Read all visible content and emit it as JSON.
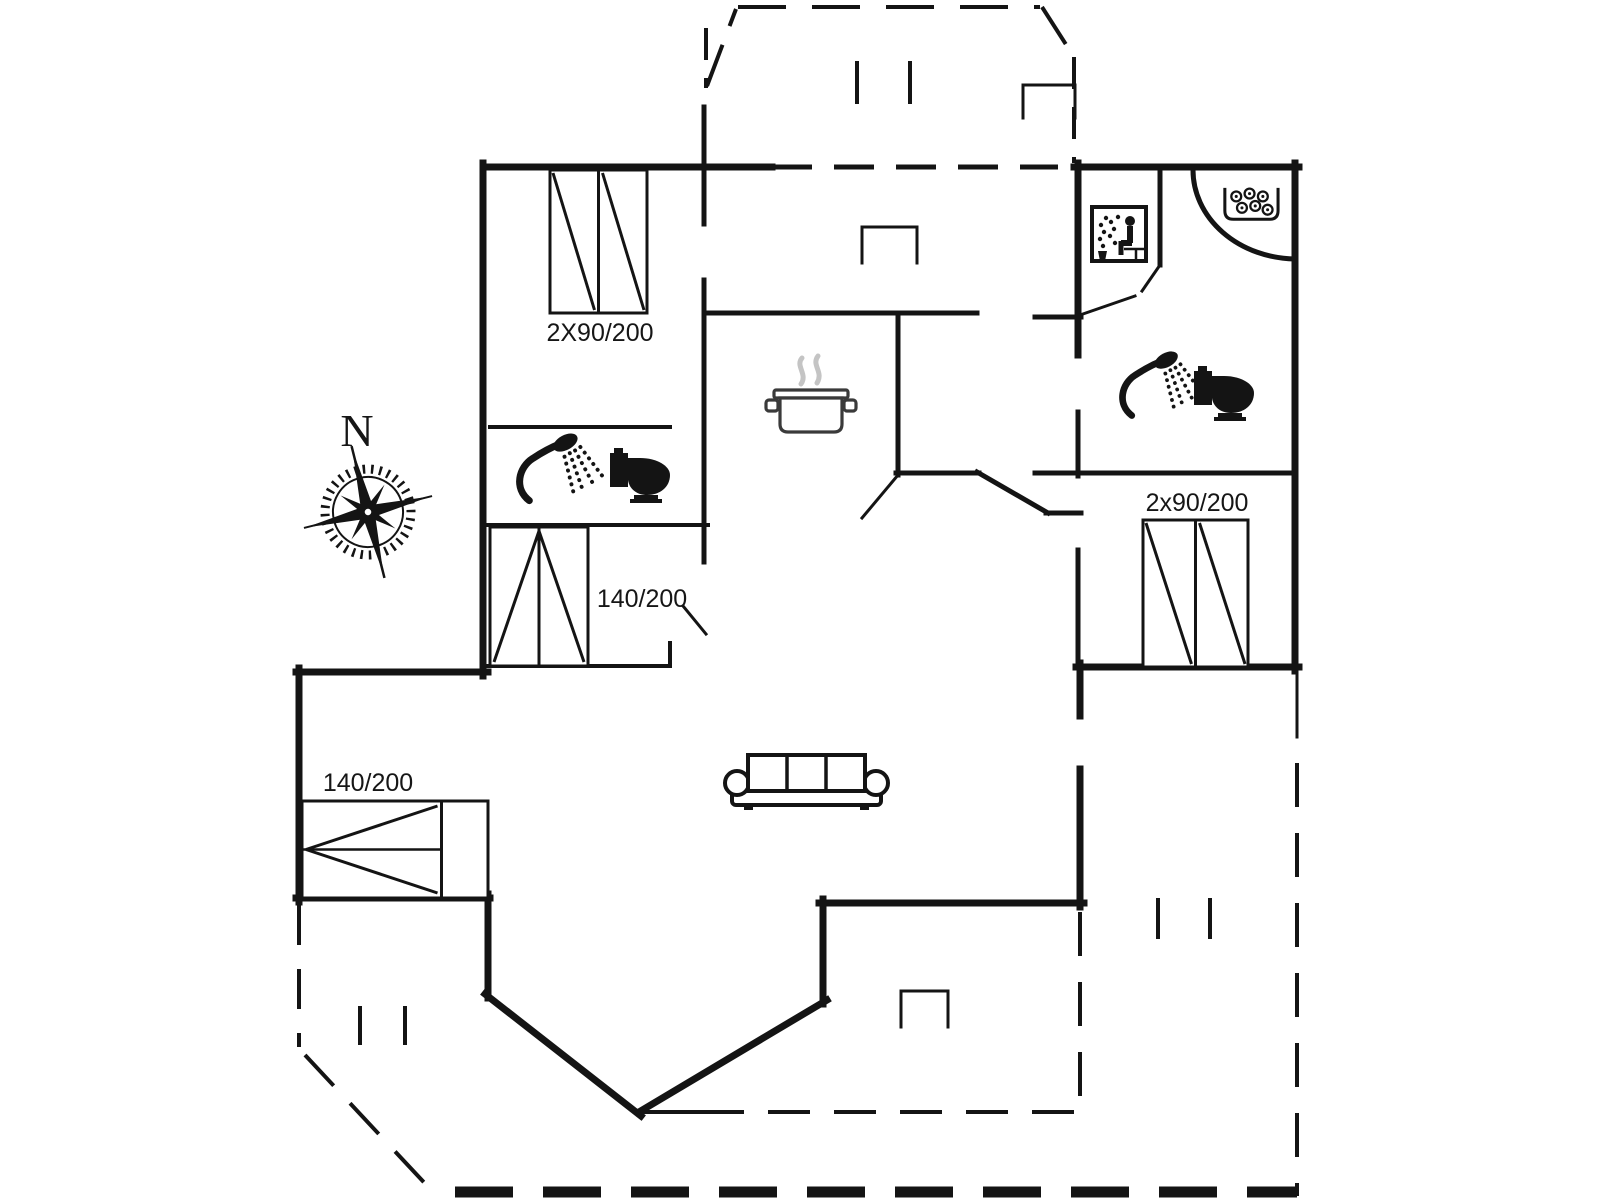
{
  "canvas": {
    "width": 1600,
    "height": 1200,
    "background": "#ffffff",
    "ink": "#141414"
  },
  "labels": [
    {
      "name": "dim-bed-top-left",
      "text": "2X90/200",
      "x": 600,
      "y": 341,
      "size": 25,
      "font": "sans"
    },
    {
      "name": "dim-bed-mid-left",
      "text": "140/200",
      "x": 642,
      "y": 607,
      "size": 25,
      "font": "sans"
    },
    {
      "name": "dim-bed-bottom-left",
      "text": "140/200",
      "x": 368,
      "y": 791,
      "size": 25,
      "font": "sans"
    },
    {
      "name": "dim-bed-right",
      "text": "2x90/200",
      "x": 1197,
      "y": 511,
      "size": 25,
      "font": "sans"
    },
    {
      "name": "compass-north-label",
      "text": "N",
      "x": 357,
      "y": 446,
      "size": 46,
      "font": "serif"
    }
  ],
  "walls": [
    [
      483,
      167,
      772,
      167,
      7
    ],
    [
      483,
      163,
      483,
      676,
      7
    ],
    [
      296,
      672,
      488,
      672,
      7
    ],
    [
      299,
      668,
      299,
      902,
      7
    ],
    [
      296,
      898,
      490,
      898,
      7
    ],
    [
      488,
      894,
      488,
      998,
      7
    ],
    [
      485,
      994,
      641,
      1116,
      7
    ],
    [
      639,
      1112,
      827,
      1000,
      7
    ],
    [
      823,
      1004,
      823,
      899,
      7
    ],
    [
      819,
      903,
      1084,
      903,
      7
    ],
    [
      1080,
      907,
      1080,
      769,
      7
    ],
    [
      1080,
      716,
      1080,
      663,
      7
    ],
    [
      1076,
      667,
      1299,
      667,
      7
    ],
    [
      1295,
      671,
      1295,
      163,
      7
    ],
    [
      1074,
      167,
      1299,
      167,
      7
    ],
    [
      1078,
      163,
      1078,
      355,
      7
    ],
    [
      1078,
      412,
      1078,
      476,
      5
    ],
    [
      1078,
      550,
      1078,
      667,
      5
    ],
    [
      704,
      107,
      704,
      224,
      5
    ],
    [
      704,
      280,
      704,
      562,
      5
    ],
    [
      705,
      313,
      977,
      313,
      5
    ],
    [
      898,
      316,
      898,
      475,
      5
    ],
    [
      896,
      473,
      979,
      473,
      5
    ],
    [
      977,
      472,
      1048,
      513,
      5
    ],
    [
      1046,
      513,
      1081,
      513,
      5
    ],
    [
      1035,
      317,
      1081,
      317,
      5
    ],
    [
      1035,
      473,
      1295,
      473,
      5
    ],
    [
      1160,
      167,
      1160,
      265,
      5
    ],
    [
      490,
      427,
      670,
      427,
      4
    ],
    [
      488,
      525,
      708,
      525,
      4
    ],
    [
      488,
      666,
      670,
      666,
      4
    ],
    [
      670,
      643,
      670,
      666,
      4
    ],
    [
      637,
      1112,
      702,
      1112,
      4
    ],
    [
      1297,
      667,
      1297,
      737,
      3
    ],
    [
      683,
      606,
      706,
      634,
      3
    ],
    [
      898,
      475,
      862,
      518,
      3
    ],
    [
      1080,
      315,
      1135,
      296,
      3
    ],
    [
      1160,
      265,
      1142,
      291,
      3
    ],
    [
      862,
      263,
      862,
      227,
      3
    ],
    [
      862,
      227,
      917,
      227,
      3
    ],
    [
      917,
      227,
      917,
      263,
      3
    ],
    [
      1023,
      118,
      1023,
      85,
      3
    ],
    [
      1023,
      85,
      1075,
      85,
      3
    ],
    [
      1075,
      85,
      1075,
      118,
      3
    ],
    [
      901,
      1027,
      901,
      991,
      3
    ],
    [
      901,
      991,
      948,
      991,
      3
    ],
    [
      948,
      991,
      948,
      1027,
      3
    ],
    [
      857,
      63,
      857,
      102,
      4
    ],
    [
      910,
      63,
      910,
      102,
      4
    ],
    [
      1158,
      900,
      1158,
      937,
      4
    ],
    [
      1210,
      900,
      1210,
      937,
      4
    ],
    [
      360,
      1008,
      360,
      1043,
      4
    ],
    [
      405,
      1008,
      405,
      1043,
      4
    ],
    [
      772,
      167,
      1058,
      167,
      5,
      "40,22"
    ],
    [
      706,
      28,
      706,
      88,
      4,
      "32,18"
    ],
    [
      707,
      86,
      736,
      9,
      4,
      "44,20"
    ],
    [
      738,
      7,
      1040,
      7,
      4,
      "48,26"
    ],
    [
      1042,
      7,
      1074,
      57,
      4,
      "44,20"
    ],
    [
      1074,
      57,
      1074,
      163,
      4,
      "32,18"
    ],
    [
      1297,
      763,
      1297,
      1196,
      4,
      "44,26"
    ],
    [
      1080,
      912,
      1080,
      1112,
      4,
      "44,26"
    ],
    [
      702,
      1112,
      1080,
      1112,
      4,
      "42,24"
    ],
    [
      455,
      1192,
      1297,
      1192,
      11,
      "58,30"
    ],
    [
      299,
      905,
      299,
      1047,
      4,
      "40,24"
    ],
    [
      305,
      1055,
      432,
      1191,
      4,
      "42,24"
    ]
  ],
  "arcs": [
    {
      "name": "corner-bath-arc",
      "d": "M1193,170 A104,89 0 0 0 1295,259",
      "w": 5
    }
  ],
  "beds": [
    {
      "name": "bed-top-left",
      "x": 550,
      "y": 170,
      "w": 97,
      "h": 143,
      "type": "double-v"
    },
    {
      "name": "bed-right",
      "x": 1143,
      "y": 520,
      "w": 105,
      "h": 147,
      "type": "double-v"
    },
    {
      "name": "bed-mid-left",
      "x": 490,
      "y": 527,
      "w": 98,
      "h": 139,
      "type": "single-v"
    },
    {
      "name": "bed-bottom-left",
      "x": 302,
      "y": 801,
      "w": 186,
      "h": 97,
      "type": "single-h"
    }
  ],
  "icons": [
    {
      "name": "compass-rose-icon",
      "type": "compass",
      "x": 298,
      "y": 442,
      "s": 1
    },
    {
      "name": "shower-icon",
      "type": "shower",
      "x": 517,
      "y": 432,
      "s": 0.88
    },
    {
      "name": "toilet-icon",
      "type": "toilet",
      "x": 610,
      "y": 448,
      "s": 1
    },
    {
      "name": "shower-icon",
      "type": "shower",
      "x": 1120,
      "y": 350,
      "s": 0.84
    },
    {
      "name": "toilet-icon",
      "type": "toilet",
      "x": 1194,
      "y": 366,
      "s": 1
    },
    {
      "name": "sauna-icon",
      "type": "sauna",
      "x": 1090,
      "y": 205,
      "s": 1
    },
    {
      "name": "whirlpool-icon",
      "type": "spa",
      "x": 1222,
      "y": 186,
      "s": 0.95
    },
    {
      "name": "cooking-pot-icon",
      "type": "pot",
      "x": 768,
      "y": 352,
      "s": 1
    },
    {
      "name": "sofa-icon",
      "type": "sofa",
      "x": 724,
      "y": 753,
      "s": 1
    }
  ]
}
